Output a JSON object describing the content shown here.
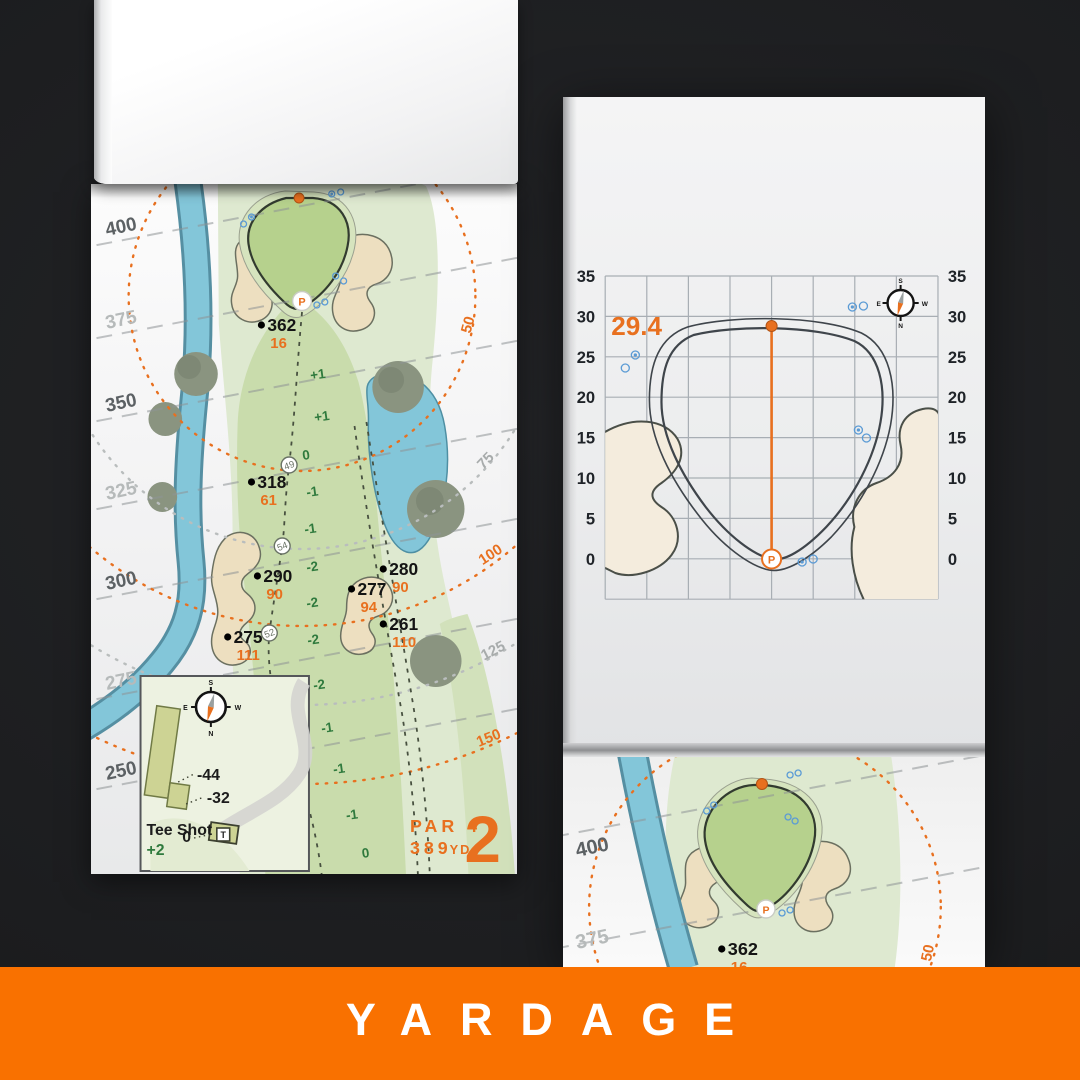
{
  "banner": {
    "label": "YARDAGE"
  },
  "colors": {
    "background": "#1D1E20",
    "banner_orange": "#F97100",
    "accent_orange": "#E8701F",
    "fairway_green": "#C9DCAC",
    "putting_green": "#B6D18D",
    "rough_green": "#DEE9D0",
    "bunker_sand": "#EDDFC0",
    "water_blue": "#83C6D9",
    "tree_gray_green": "#8A9480",
    "sprinkler_blue": "#5B9BD5",
    "elevation_green": "#2F7A3D"
  },
  "hole_page": {
    "scale_labels": [
      "400",
      "375",
      "350",
      "325",
      "300",
      "275",
      "250"
    ],
    "arc_labels": [
      "50",
      "75",
      "100",
      "125",
      "150"
    ],
    "points": [
      {
        "distance": "362",
        "remaining": "16"
      },
      {
        "distance": "318",
        "remaining": "61"
      },
      {
        "distance": "290",
        "remaining": "90"
      },
      {
        "distance": "280",
        "remaining": "90"
      },
      {
        "distance": "277",
        "remaining": "94"
      },
      {
        "distance": "261",
        "remaining": "110"
      },
      {
        "distance": "275",
        "remaining": "111"
      }
    ],
    "waypoints": [
      "49",
      "54",
      "52"
    ],
    "elevations": [
      "+1",
      "+1",
      "0",
      "-1",
      "-1",
      "-2",
      "-2",
      "-2",
      "-2",
      "-1",
      "-1",
      "-1",
      "0"
    ],
    "pin_symbol": "P",
    "hole": {
      "par": "PAR 4",
      "yardage": "389",
      "unit": "YD",
      "number": "2"
    },
    "inset": {
      "title": "Tee Shot",
      "score": "+2",
      "back_marker": "-44",
      "mid_marker": "-32",
      "front_marker": "0",
      "tee_symbol": "T"
    },
    "compass": {
      "n": "N",
      "s": "S",
      "e": "E",
      "w": "W"
    }
  },
  "green_page": {
    "measurement": "29.4",
    "axis_ticks": [
      "35",
      "30",
      "25",
      "20",
      "15",
      "10",
      "5",
      "0"
    ],
    "pin_symbol": "P",
    "compass": {
      "n": "N",
      "s": "S",
      "e": "E",
      "w": "W"
    }
  },
  "next_page": {
    "scale_labels": [
      "400",
      "375"
    ],
    "arc_label": "50",
    "point": {
      "distance": "362",
      "remaining": "16"
    }
  }
}
